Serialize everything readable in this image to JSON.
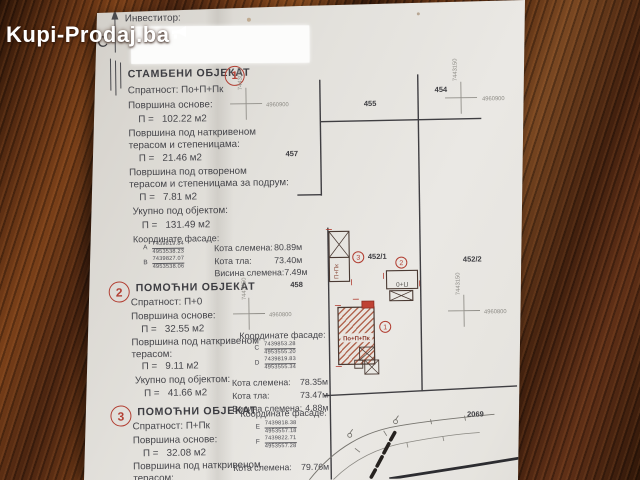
{
  "watermark": {
    "brand": "Kupi-Prodaj.ba"
  },
  "doc": {
    "investor_label": "Инвеститор:",
    "north_label": "С",
    "s1": {
      "num": "1",
      "title": "СТАМБЕНИ ОБЈЕКАТ",
      "spratnost": "Спратност: По+П+Пк",
      "area_base_label": "Површина основе:",
      "area_base_value": "П =   102.22 м2",
      "covered_1": "Површина под наткривеном",
      "covered_2": "терасом и степеницама:",
      "covered_value": "П =   21.46 м2",
      "open_1": "Површина под отвореном",
      "open_2": "терасом и степеницама за подрум:",
      "open_value": "П =   7.81 м2",
      "total_label": "Укупно под објектом:",
      "total_value": "П =   131.49 м2",
      "coords_label": "Координате фасаде:",
      "pA": {
        "id": "A",
        "e": "7439819.84",
        "n": "4953538.23"
      },
      "pB": {
        "id": "B",
        "e": "7439827.07",
        "n": "4953538.06"
      },
      "kota1_l": "Кота слемена:",
      "kota1_v": "80.89м",
      "kota2_l": "Кота тла:",
      "kota2_v": "73.40м",
      "kota3_l": "Висина слемена:",
      "kota3_v": "7.49м"
    },
    "s2": {
      "num": "2",
      "title": "ПОМОЋНИ ОБЈЕКАТ",
      "spratnost": "Спратност: П+0",
      "area_base_label": "Површина основе:",
      "area_base_value": "П =   32.55 м2",
      "covered_1": "Површина под наткривеном",
      "covered_2": "терасом:",
      "covered_value": "П =   9.11 м2",
      "total_label": "Укупно под објектом:",
      "total_value": "П =   41.66 м2",
      "coords_label": "Координате фасаде:",
      "pC": {
        "id": "C",
        "e": "7439853.28",
        "n": "4953555.20"
      },
      "pD": {
        "id": "D",
        "e": "7439819.83",
        "n": "4953555.34"
      },
      "kota1_l": "Кота слемена:",
      "kota1_v": "78.35м",
      "kota2_l": "Кота тла:",
      "kota2_v": "73.47м",
      "kota3_l": "Висина слемена:",
      "kota3_v": "4.88м"
    },
    "s3": {
      "num": "3",
      "title": "ПОМОЋНИ ОБЈЕКАТ",
      "spratnost": "Спратност: П+Пк",
      "area_base_label": "Површина основе:",
      "area_base_value": "П =   32.08 м2",
      "covered_1": "Површина под наткривеном",
      "covered_2": "терасом:",
      "coords_label": "Координате фасаде:",
      "pE": {
        "id": "E",
        "e": "7439818.38",
        "n": "4953557.18"
      },
      "pF": {
        "id": "F",
        "e": "7439822.71",
        "n": "4953557.28"
      },
      "kota1_l": "Кота слемена:",
      "kota1_v": "79.76м"
    }
  },
  "map": {
    "parcels": {
      "p455": "455",
      "p454": "454",
      "p457": "457",
      "p458": "458",
      "p452_1": "452/1",
      "p452_2": "452/2",
      "p2069": "2069"
    },
    "grid": {
      "x_left": "7443050",
      "x_right": "7443150",
      "y_top": "4960900",
      "y_bottom": "4960800"
    },
    "buildings": {
      "b1_label": "По+П+Пк",
      "b1_num": "1",
      "b2_label": "П+0",
      "b2_num": "2",
      "b3_label": "П+Пк",
      "b3_num": "3"
    }
  },
  "colors": {
    "accent_red": "#b23f33",
    "ink": "#3d3d42",
    "paper": "#e0ddd7"
  }
}
